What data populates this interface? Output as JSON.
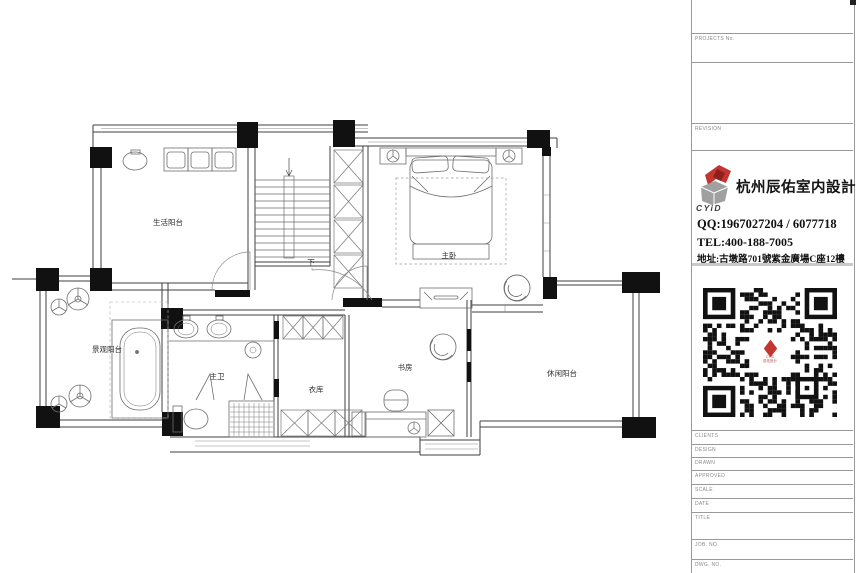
{
  "plan": {
    "rooms": {
      "laundry_balcony": "生活阳台",
      "master_bedroom": "主卧",
      "view_balcony": "景观阳台",
      "master_bath": "主卫",
      "closet": "衣库",
      "study": "书房",
      "leisure_balcony": "休闲阳台",
      "stair_down": "下"
    }
  },
  "title_block": {
    "project_no_label": "PROJECTS No.",
    "revision_label": "REVISION",
    "company_name": "杭州辰佑室内設計",
    "logo_acronym": "CYiD",
    "qq_line": "QQ:1967027204  /  6077718",
    "tel_line": "TEL:400-188-7005",
    "address_line": "地址:古墩路701號紫金廣場C座12樓",
    "fields": [
      "CLIENTS",
      "DESIGN",
      "DRAWN",
      "APPROVED",
      "SCALE",
      "DATE",
      "TITLE",
      "JOB. NO.",
      "DWG. NO."
    ],
    "colors": {
      "logo_red": "#c23531",
      "logo_gray": "#a0a0a0",
      "line_gray": "#9a9a9a",
      "wall_ink": "#3f3f3f"
    }
  }
}
